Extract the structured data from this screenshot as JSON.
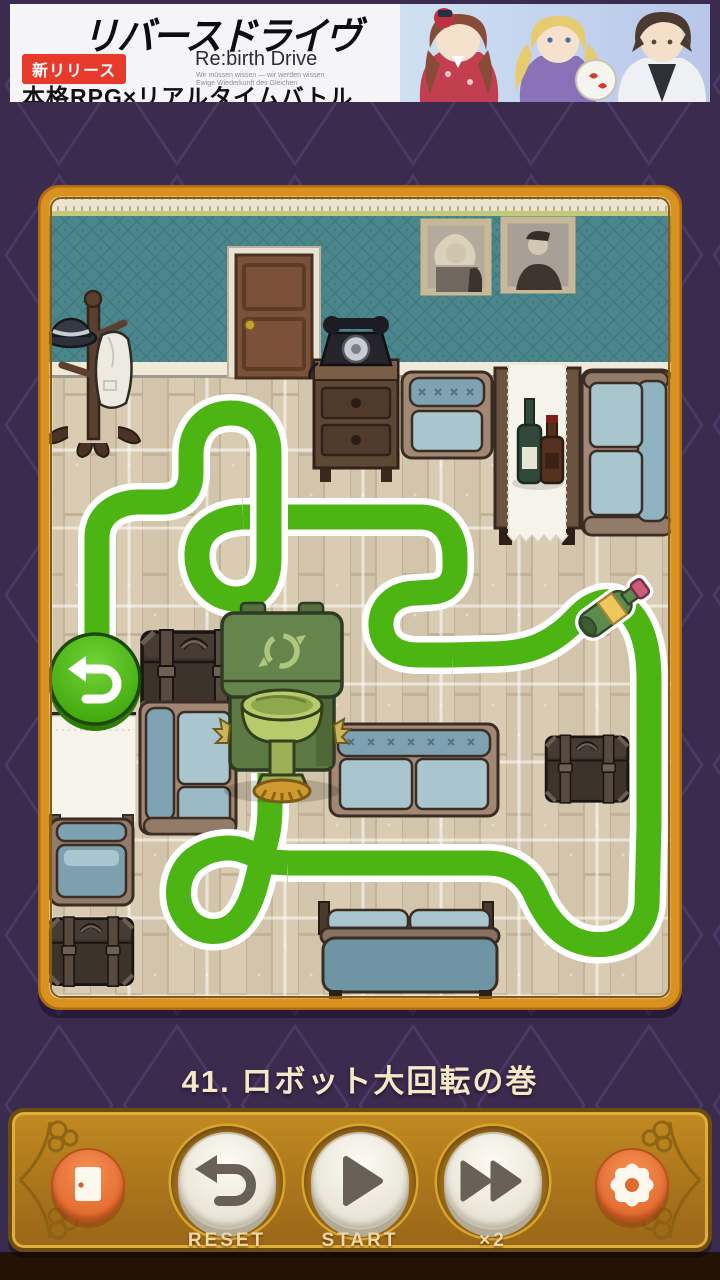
{
  "ad": {
    "logo": "リバースドライヴ",
    "title_en": "Re:birth Drive",
    "subtext_line1": "Wir müssen wissen — wir werden wissen",
    "subtext_line2": "Ewige Wiederkunft des Gleichen",
    "badge": "新リリース",
    "tagline": "本格RPG×リアルタイムバトル"
  },
  "level": {
    "title": "41. ロボット大回転の巻"
  },
  "controls": {
    "reset_label": "RESET",
    "start_label": "START",
    "speed_label": "×2"
  },
  "board": {
    "robot": "recycle-bin-robot",
    "path_item": "wine-bottle",
    "goal": "goal-undo-button",
    "path_color": "#4CB514"
  },
  "colors": {
    "background": "#3B2B4E",
    "frame": "#D9921F",
    "panel": "#B9841F",
    "accent_orange": "#E8703D",
    "wall": "#4A868B",
    "floor": "#D9CCB3",
    "path_green": "#4CB514"
  }
}
